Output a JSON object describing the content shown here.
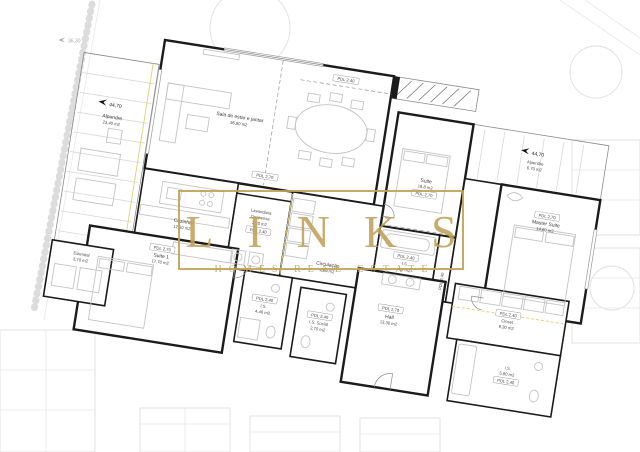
{
  "watermark": {
    "brand": "LINKS",
    "tagline": "HOMES REAL ESTATE",
    "gold_color": "#c1a156"
  },
  "rooms": {
    "alpendre_left": {
      "level": "44,70",
      "name": "Alpendre",
      "area": "23,40 m2"
    },
    "sala": {
      "name": "Sala de estar e jantar",
      "area": "36,80 m2"
    },
    "cozinha": {
      "name": "Cozinha",
      "area": "12,50 m2"
    },
    "lavandaria": {
      "name": "Lavandaria",
      "name2": "Despensa",
      "area": "3,20 m2",
      "pdl": "PDL 2,40"
    },
    "circulacao": {
      "name": "Circulação",
      "area": "4,60 m2"
    },
    "suite": {
      "name": "Suite",
      "area": "18,8 m2",
      "pdl": "PDL 2,70"
    },
    "is_suite": {
      "pdl": "PDL 2,40",
      "name": "I.S.",
      "area": "4,9 m2"
    },
    "closet_suite": {
      "pdl": "PDL 2,40"
    },
    "master": {
      "pdl": "PDL 2,70",
      "name": "Master Suite",
      "area": "14,60 m2"
    },
    "alpendre_right": {
      "level": "44,70",
      "name": "Alpendre",
      "area": "6,70 m2"
    },
    "suite1": {
      "pdl": "PDL 2,70",
      "name": "Suite 1",
      "area": "17,70 m2"
    },
    "estendal": {
      "name": "Estendal",
      "area": "3,70 m2"
    },
    "is1": {
      "pdl": "PDL 2,40",
      "name": "I.S.",
      "area": "4,40 m2"
    },
    "is_social": {
      "pdl": "PDL 2,40",
      "name": "I.S. Social",
      "area": "2,70 m2"
    },
    "hall": {
      "pdl": "PDL 2,70",
      "name": "Hall",
      "area": "13,30 m2"
    },
    "closet": {
      "pdl": "PDL 2,40",
      "name": "Closet",
      "area": "9,30 m2"
    },
    "is_master": {
      "name": "I.S.",
      "area": "5,90 m2",
      "pdl": "PDL 2,40"
    }
  },
  "ceiling_labels": {
    "sala_pdl": "PDL 2,70",
    "beam_pdl": "PDL 2,40"
  },
  "site": {
    "levels": {
      "topleft": "36,30",
      "right_upper": "39,50",
      "right_lower": "41,50"
    }
  }
}
